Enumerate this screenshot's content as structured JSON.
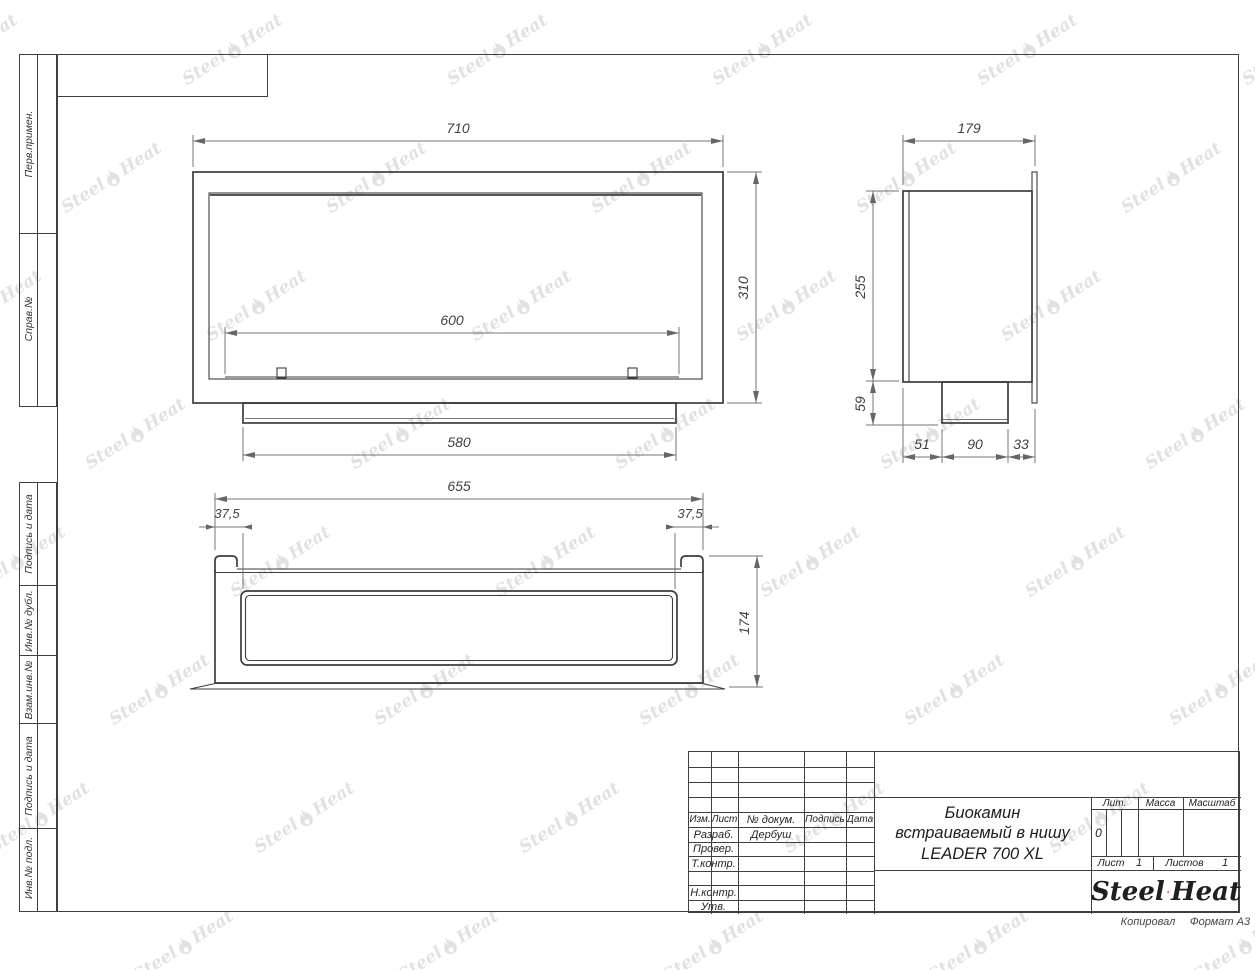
{
  "page": {
    "copied_label": "Копировал",
    "format_label": "Формат A3"
  },
  "watermark": {
    "steel": "Steel",
    "heat": "Heat"
  },
  "left_strip": {
    "labels": [
      "Перв.примен.",
      "Справ.№",
      "Подпись и дата",
      "Инв.№ дубл.",
      "Взам.инв.№",
      "Подпись и дата",
      "Инв.№ подл."
    ]
  },
  "views": {
    "front": {
      "width": "710",
      "height": "310",
      "opening_width": "600",
      "tray_width": "580"
    },
    "side": {
      "depth": "179",
      "height": "255",
      "burner_depth": "59",
      "bottom_left": "51",
      "bottom_center": "90",
      "bottom_right": "33"
    },
    "top": {
      "width": "655",
      "inset_left": "37,5",
      "inset_right": "37,5",
      "depth": "174"
    }
  },
  "title_block": {
    "header": {
      "izm": "Изм.",
      "list": "Лист",
      "doc": "№ докум.",
      "sign": "Подпись",
      "date": "Дата"
    },
    "rows": [
      {
        "label": "Разраб.",
        "value": "Дербуш"
      },
      {
        "label": "Провер.",
        "value": ""
      },
      {
        "label": "Т.контр.",
        "value": ""
      },
      {
        "label": "",
        "value": ""
      },
      {
        "label": "Н.контр.",
        "value": ""
      },
      {
        "label": "Утв.",
        "value": ""
      }
    ],
    "title_lines": [
      "Биокамин",
      "встраиваемый в нишу",
      "LEADER 700 XL"
    ],
    "lit": {
      "label": "Лит.",
      "value": "0"
    },
    "massa_label": "Масса",
    "masshtab_label": "Масштаб",
    "sheet": {
      "list_label": "Лист",
      "list_value": "1",
      "listov_label": "Листов",
      "listov_value": "1"
    },
    "logo": {
      "steel": "Steel",
      "heat": "Heat"
    }
  },
  "colors": {
    "object_line": "#3d3d3d",
    "dim_line": "#757575",
    "dim_text": "#3f3f3f",
    "watermark": "#dfe1e4",
    "flame_red": "#e8251d",
    "logo_text": "#1f1f1f"
  }
}
